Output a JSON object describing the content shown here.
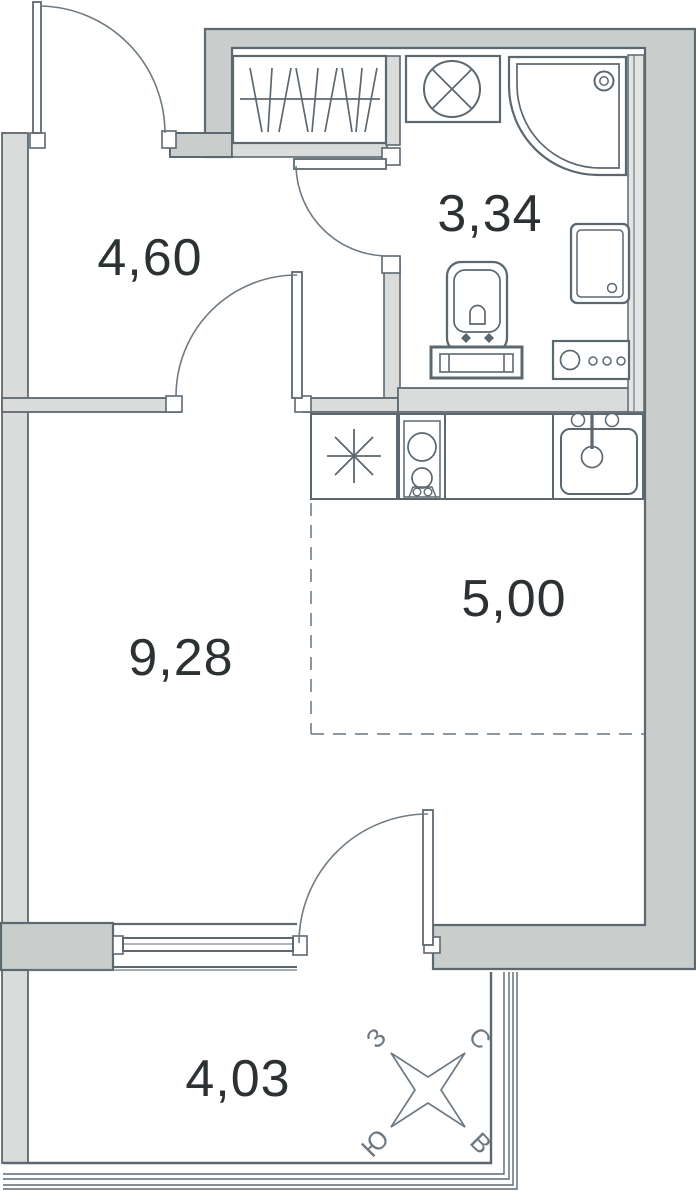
{
  "plan": {
    "type": "apartment-floor-plan",
    "rooms": {
      "hallway": {
        "name": "hallway",
        "area": "4,60"
      },
      "bathroom": {
        "name": "bathroom",
        "area": "3,34"
      },
      "living_room": {
        "name": "living-room",
        "area": "9,28"
      },
      "kitchen_zone": {
        "name": "kitchen-zone",
        "area": "5,00"
      },
      "balcony": {
        "name": "balcony",
        "area": "4,03"
      }
    },
    "compass": {
      "west": "З",
      "north": "С",
      "south": "Ю",
      "east": "В"
    },
    "icons": [
      "wardrobe-icon",
      "washing-machine-icon",
      "shower-icon",
      "toilet-icon",
      "bathroom-cabinet-icon",
      "vanity-icon",
      "refrigerator-icon",
      "stove-icon",
      "kitchen-sink-icon",
      "window-icon",
      "door-swing-icon",
      "compass-rose-icon"
    ],
    "colors": {
      "wall_outer": "#c9cdcc",
      "wall_inner": "#d9dcdb",
      "line": "#5c6870",
      "line_soft": "#6e7a82",
      "dash": "#8b97a0",
      "text": "#2c3134",
      "compass_text": "#6d7880"
    }
  }
}
